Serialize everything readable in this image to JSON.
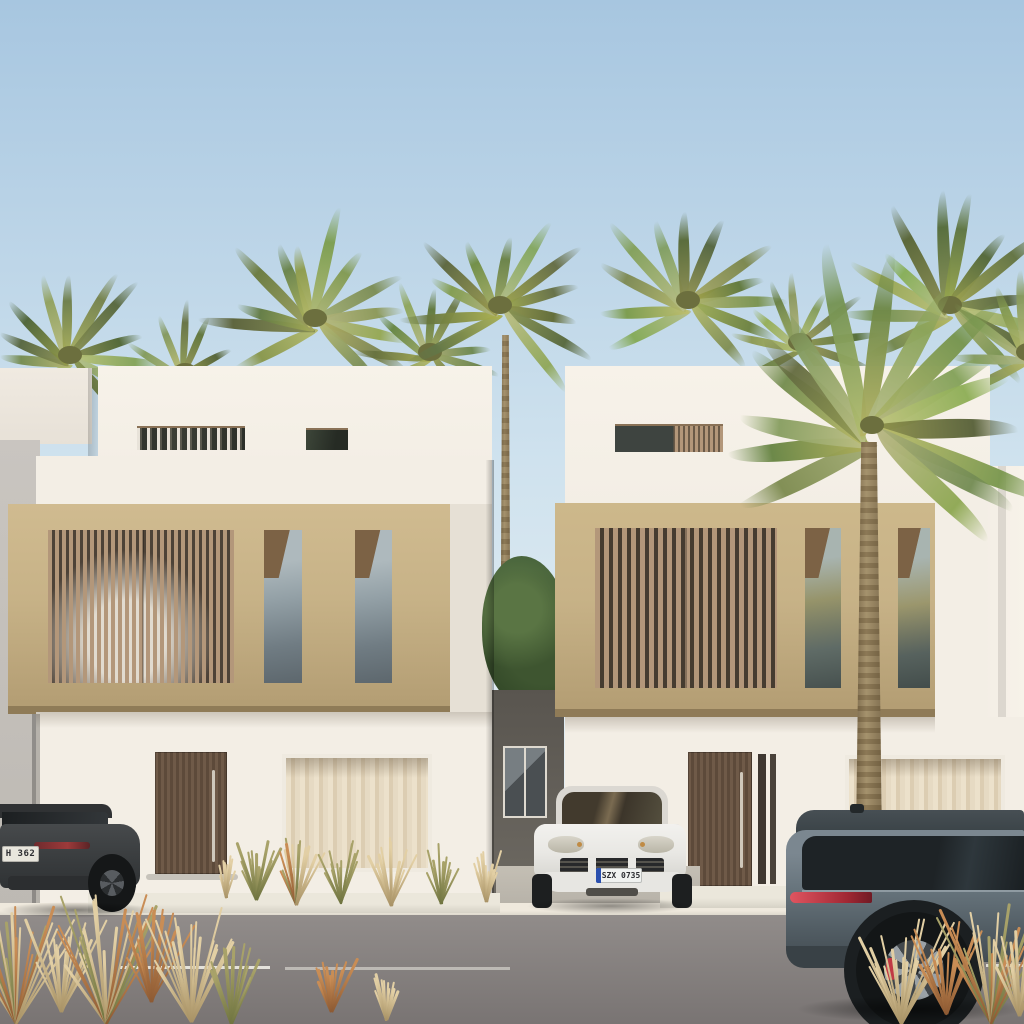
{
  "scene": {
    "title": "Architectural rendering of two modern white villas with beige stone facades, palm trees and parked cars",
    "setting": "sunny daytime street elevation"
  },
  "vehicles": {
    "left_suv": {
      "description": "dark grey SUV, rear view, parked left",
      "plate_text": "H 362"
    },
    "center_suv": {
      "description": "white SUV parked in driveway between villas",
      "plate_text": "SZX 0735"
    },
    "right_suv": {
      "description": "slate blue-grey SUV driving past on the right",
      "plate_text": ""
    }
  },
  "palette": {
    "sky_top": "#a7c6e0",
    "sky_mid": "#cfe2ee",
    "sky_bottom": "#e3edf2",
    "wall_white": "#f3eee5",
    "wall_white_bright": "#f7f2e9",
    "wall_side": "#e6e0d5",
    "wall_shadow": "#c7c2bc",
    "neighbor_grey": "#c9c5c0",
    "stone_beige": "#c7b287",
    "stone_beige_light": "#d0bb90",
    "stone_beige_dark": "#b29c72",
    "stone_underside": "#8f7b57",
    "slat_wood": "#b3977a",
    "slat_gap": "#4d4237",
    "reveal_brown": "#7c6245",
    "door_wood": "#6f5a48",
    "door_wood_dark": "#5d4a3a",
    "curtain_light": "#ece1cb",
    "curtain_dark": "#dccdb2",
    "glass_sky": "#aeb9bd",
    "glass_deep": "#5d676d",
    "glass_dark": "#33373a",
    "passage_wall": "#59554f",
    "asphalt_light": "#918c8a",
    "asphalt_dark": "#797473",
    "curb_white": "#efe9dd",
    "driveway": "#b4afa6",
    "palm_green": "#7f814c",
    "palm_dark": "#555c33",
    "trunk_tan": "#a5926d",
    "grass_olive": "#7d8048",
    "grass_wheat": "#d8bf97",
    "grass_rust": "#b3703f",
    "car_white": "#e9e8e4",
    "car_dark": "#3d4042",
    "car_slate": "#67747c",
    "tail_red": "#a02733",
    "brake_red": "#c03a45",
    "plate_blue": "#2a4fae"
  }
}
